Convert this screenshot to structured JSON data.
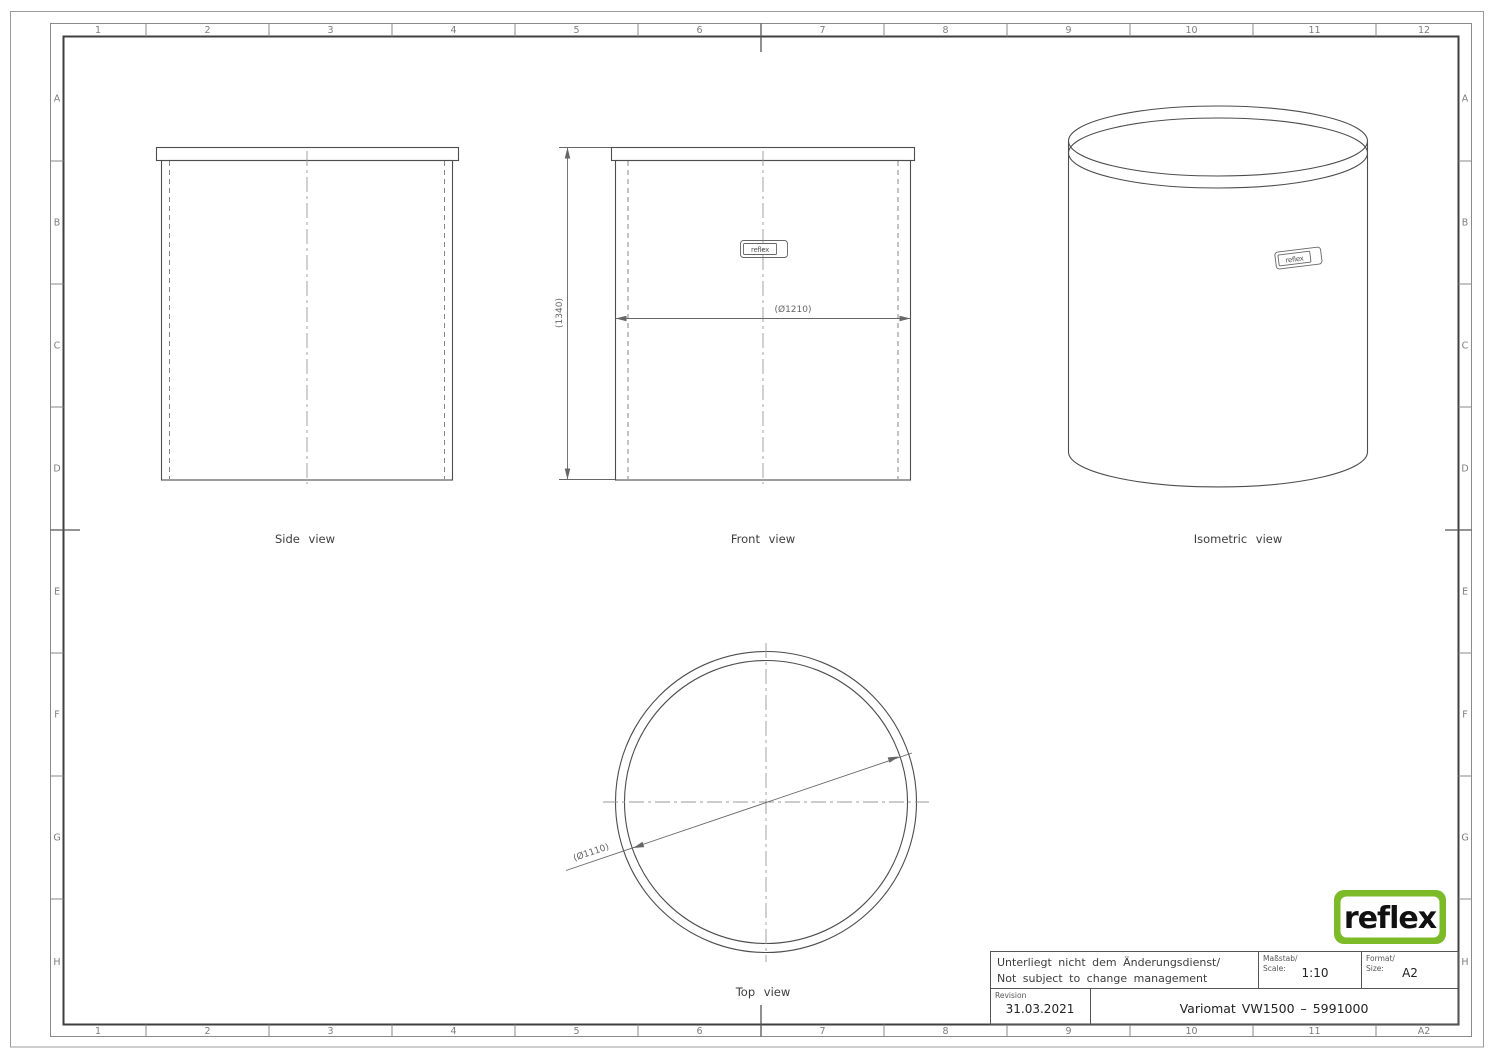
{
  "colors": {
    "line": "#4d4d4d",
    "frame": "#3f3f3f",
    "dim": "#666666",
    "logo_green": "#7dba28"
  },
  "rulers": {
    "top": [
      "1",
      "2",
      "3",
      "4",
      "5",
      "6",
      "7",
      "8",
      "9",
      "10",
      "11",
      "12"
    ],
    "bottom": [
      "1",
      "2",
      "3",
      "4",
      "5",
      "6",
      "7",
      "8",
      "9",
      "10",
      "11",
      "A2"
    ],
    "left": [
      "A",
      "B",
      "C",
      "D",
      "E",
      "F",
      "G",
      "H"
    ],
    "right": [
      "A",
      "B",
      "C",
      "D",
      "E",
      "F",
      "G",
      "H"
    ]
  },
  "views": {
    "side": {
      "label": "Side view"
    },
    "front": {
      "label": "Front view",
      "height_dim": "(1340)",
      "diameter_dim": "(Ø1210)",
      "badge": "reflex"
    },
    "isometric": {
      "label": "Isometric view",
      "badge": "reflex"
    },
    "top": {
      "label": "Top view",
      "diameter_dim": "(Ø1110)"
    }
  },
  "title_block": {
    "note_de": "Unterliegt nicht dem Änderungsdienst/",
    "note_en": "Not subject to change management",
    "scale_label_de": "Maßstab/",
    "scale_label_en": "Scale:",
    "scale_value": "1:10",
    "format_label_de": "Format/",
    "format_label_en": "Size:",
    "format_value": "A2",
    "revision_label": "Revision",
    "revision_date": "31.03.2021",
    "drawing_title": "Variomat VW1500 – 5991000"
  },
  "logo": {
    "text": "reflex"
  }
}
